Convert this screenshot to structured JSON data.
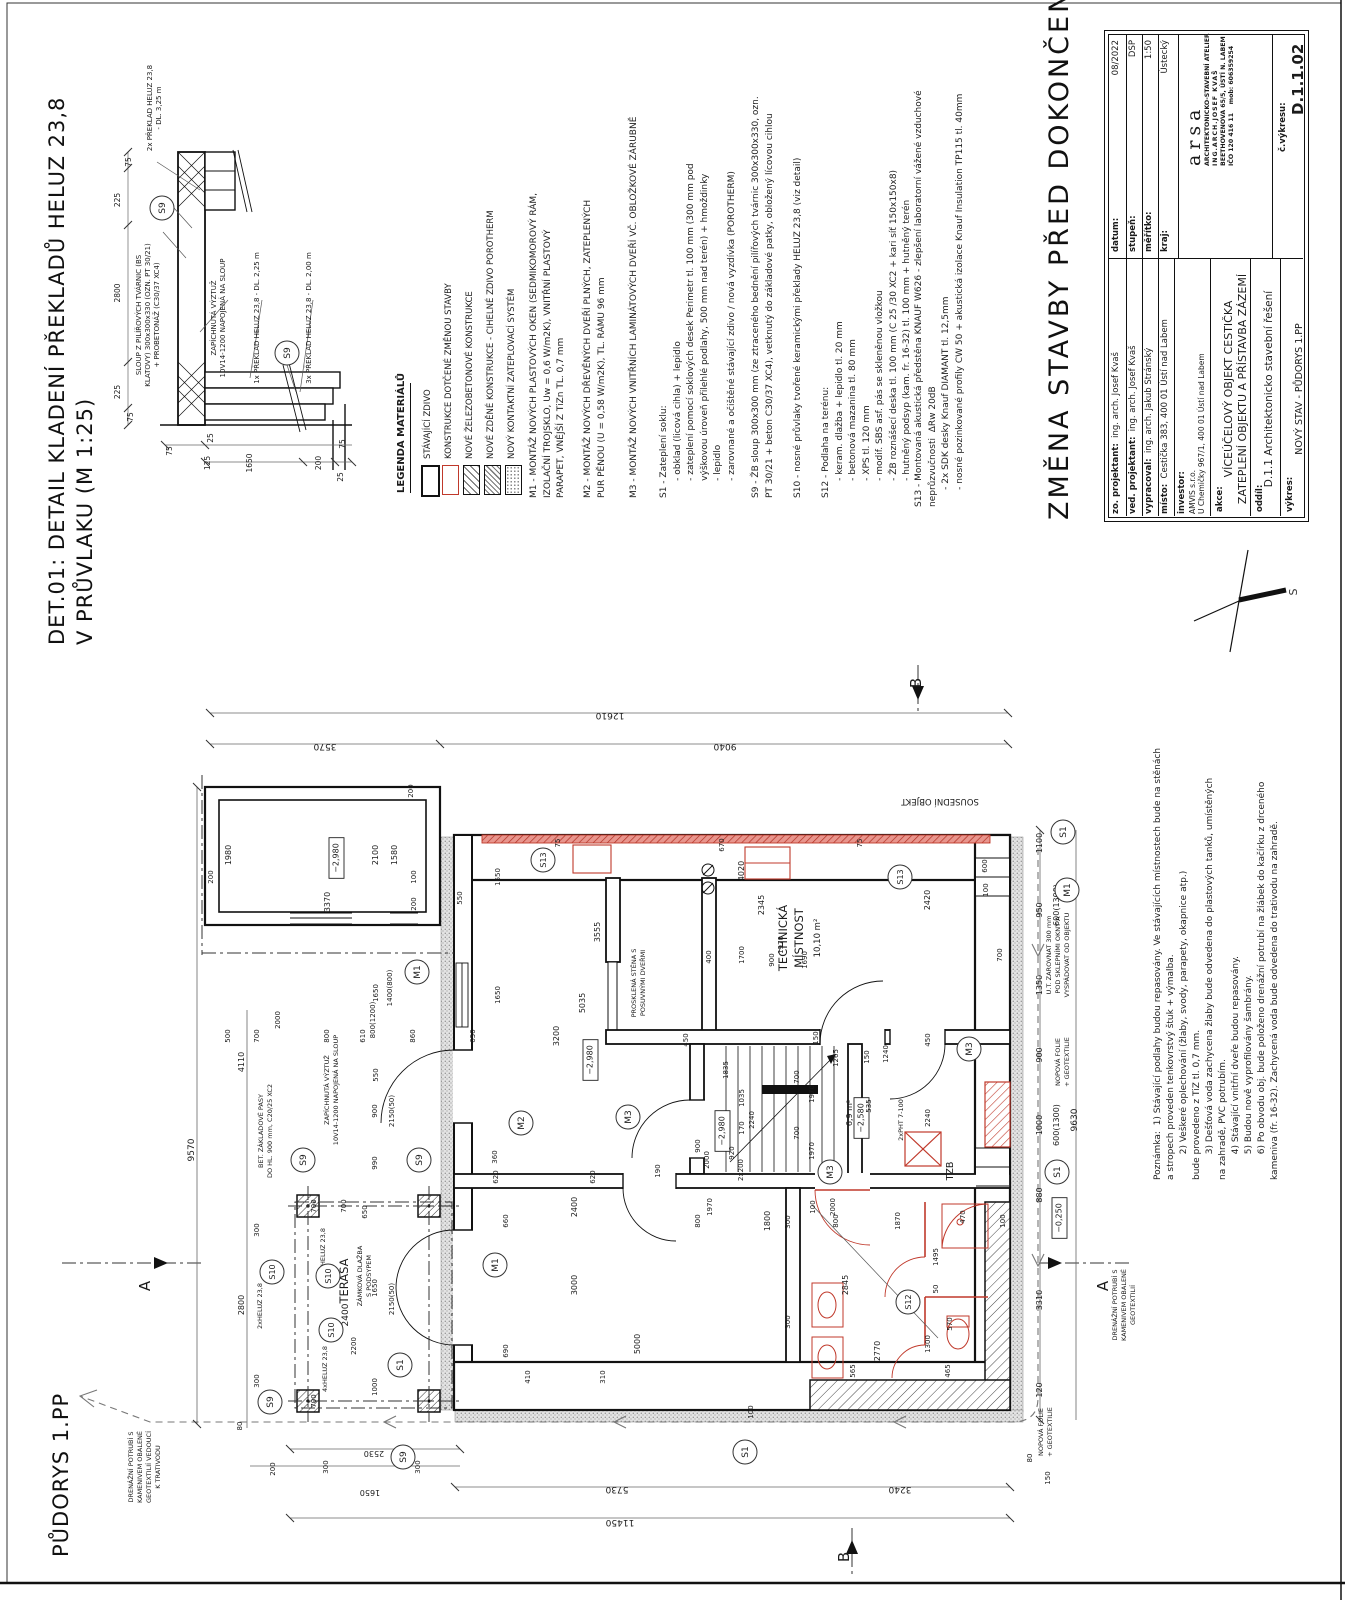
{
  "titles": {
    "det_line1": "DET.01: DETAIL KLADENÍ PŘEKLADŮ HELUZ 23,8",
    "det_line2": "V PRŮVLAKU (M 1:25)",
    "plan_title": "PŮDORYS 1.PP",
    "main_title": "ZMĚNA STAVBY PŘED DOKONČENÍM"
  },
  "compass": {
    "label": "S"
  },
  "legend": {
    "title": "LEGENDA MATERIÁLŮ",
    "items": [
      {
        "label": "STÁVAJÍCÍ ZDIVO",
        "swatch": "existing-masonry"
      },
      {
        "label": "KONSTRUKCE DOTČENÉ ZMĚNOU STAVBY",
        "swatch": "affected-red-outline"
      },
      {
        "label": "NOVÉ ŽELEZOBETONOVÉ KONSTRUKCE",
        "swatch": "new-rc-hatch"
      },
      {
        "label": "NOVÉ ZDĚNÉ KONSTRUKCE - CIHELNÉ ZDIVO POROTHERM",
        "swatch": "new-brick-hatch"
      },
      {
        "label": "NOVÝ KONTAKTNÍ ZATEPLOVACÍ SYSTÉM",
        "swatch": "etics-dots"
      }
    ]
  },
  "notes": {
    "m1": "M1 - MONTÁŽ NOVÝCH PLASTOVÝCH OKEN (SEDMIKOMOROVÝ RÁM,\nIZOLAČNÍ TROJSKLO, Uw = 0,6 W/m2K), VNITŘNÍ PLASTOVÝ\nPARAPET, VNĚJŠÍ Z TiZn TL. 0,7 mm",
    "m2": "M2 - MONTÁŽ NOVÝCH DŘEVĚNÝCH DVEŘÍ PLNÝCH, ZATEPLENÝCH\nPUR PĚNOU (U = 0,58 W/m2K), TL. RÁMU 96 mm",
    "m3": "M3 - MONTÁŽ NOVÝCH VNITŘNÍCH LAMINÁTOVÝCH DVEŘÍ VČ. OBLOŽKOVÉ ZÁRUBNĚ",
    "s1": "S1 - Zateplení soklu:\n      - obklad (licová cihla) + lepidlo\n      - zateplení pomocí soklových desek Perimetr tl. 100 mm (300 mm pod\n      výškovou úroveň přilehlé podlahy, 500 mm nad terén) + hmoždinky\n      - lepidlo\n      - zarovnané a očištěné stávající zdivo / nová vyzdívka (POROTHERM)",
    "s9": "S9 - ŽB sloup 300x300 mm (ze ztraceného bednění pilířových tvárnic 300x300x330, ozn.\nPT 30/21 + beton C30/37 XC4), vetknutý do základové patky, obložený lícovou cihlou",
    "s10": "S10 - nosné průvlaky tvořené keramickými překlady HELUZ 23,8 (viz detail)",
    "s12": "S12 - Podlaha na terénu:\n      - keram. dlažba + lepidlo tl. 20 mm\n      - betonová mazanina tl. 80 mm\n      - XPS tl. 120 mm\n      - modif. SBS asf. pás se skleněnou vložkou\n      - ŽB roznášecí deska tl. 100 mm (C 25 /30 XC2 + kari síť 150x150x8)\n      - hutněný podsyp (kam. fr. 16-32) tl. 100 mm + hutněný terén",
    "s13": "S13 - Montovaná akustická předstěna KNAUF W626 - zlepšení laboratorní vážené vzduchové\nneprůzvučnosti  ΔRw 20dB\n      - 2x SDK desky Knauf DIAMANT tl. 12,5mm\n      - nosné pozinkované profily CW 50 + akustická izolace Knauf Insulation TP115 tl. 40mm",
    "poznamka": "Poznámka:  1) Stávající podlahy budou repasovány. Ve stávajících místnostech bude na stěnách\na stropech proveden tenkovrstvý štuk + výmalba.\n         2) Veškeré oplechování (žlaby, svody, parapety, okapnice atp.)\nbude provedeno z TiZ tl. 0,7 mm.\n         3) Dešťová voda zachycena žlaby bude odvedena do plastových tanků, umístěných\nna zahradě, PVC potrubím.\n         4) Stávající vnitřní dveře budou repasovány.\n         5) Budou nově vyprofilovány šambrány.\n         6) Po obvodu obj. bude položeno drenážní potrubí na žlábek do kačírku z drceného\nkameniva (fr. 16-32). Zachycená voda bude odvedena do trativodu na zahradě."
  },
  "titleblock": {
    "rows": {
      "zo_label": "zo. projektant:",
      "zo_value": "  ing. arch. Josef Kvaš",
      "ved_label": "ved. projektant:",
      "ved_value": "  ing. arch. Josef Kvaš",
      "vyp_label": "vypracoval:",
      "vyp_value": "  ing. arch. Jakub Stránský",
      "misto_label": "místo:",
      "misto_value": "  Cestička 383, 400 01 Ústí nad Labem",
      "inv_label": "investor:",
      "inv_value1": "AMVIS s.r.o.",
      "inv_value2": "U Chemičky 967/1, 400 01 Ústí nad Labem",
      "akce_label": "akce:",
      "akce_value1": "VÍCEÚČELOVÝ OBJEKT CESTIČKA",
      "akce_value2": "ZATEPLENÍ OBJEKTU A PŘÍSTAVBA ZÁZEMÍ",
      "oddil_label": "oddíl:",
      "oddil_value": "D.1.1 Architektonicko stavební řešení",
      "vykres_label": "výkres:",
      "vykres_value": "NOVÝ STAV - PŮDORYS 1.PP",
      "datum_label": "datum:",
      "datum_value": "08/2022",
      "stupen_label": "stupeň:",
      "stupen_value": "DSP",
      "meritko_label": "měřítko:",
      "meritko_value": "1:50",
      "kraj_label": "kraj:",
      "kraj_value": "Ústecký",
      "cis_label": "č.výkresu:",
      "cis_value": "D.1.1.02"
    },
    "arsa": {
      "logo": "arsa",
      "line1": "ARCHITEKTONICKO-STAVEBNÍ ATELIER",
      "line2": "ING.ARCH.JOSEF KVAŠ",
      "line3": "BEETHOVENOVA 65/5, ÚSTÍ N. LABEM",
      "line4": "IČO 120 416 11    mob: 606359254"
    }
  },
  "detail_stamps": [
    [
      "75",
      131,
      162,
      -90,
      7.5
    ],
    [
      "225",
      120,
      200,
      -90,
      7.5
    ],
    [
      "2800",
      120,
      293,
      -90,
      7.5
    ],
    [
      "225",
      120,
      392,
      -90,
      7.5
    ],
    [
      "75",
      133,
      417,
      -90,
      7.5
    ],
    [
      "75",
      172,
      451,
      -90,
      7.5
    ],
    [
      "25",
      213,
      438,
      -90,
      7.5
    ],
    [
      "125",
      210,
      463,
      -90,
      7.5
    ],
    [
      "1650",
      252,
      463,
      -90,
      7.5
    ],
    [
      "200",
      321,
      463,
      -90,
      7.5
    ],
    [
      "25",
      343,
      477,
      -90,
      7.5
    ],
    [
      "75",
      345,
      444,
      -90,
      7.5
    ],
    [
      "2x PŘEKLAD HELUZ 23,8",
      152,
      108,
      -90,
      7
    ],
    [
      "- DL. 3,25 m",
      161,
      108,
      -90,
      7
    ],
    [
      "SLOUP Z PILÍŘOVÝCH TVÁRNIC (BS",
      141,
      315,
      -90,
      7
    ],
    [
      "KLATOVY) 300x300x330 (OZN. PT 30/21)",
      150,
      315,
      -90,
      7
    ],
    [
      "+ PROBETONÁŽ (C30/37 XC4)",
      159,
      315,
      -90,
      7
    ],
    [
      "ZAPÍCHNUTÁ VÝZTUŽ",
      216,
      318,
      -90,
      7
    ],
    [
      "10V14-1200 NAPOJENÁ NA SLOUP",
      225,
      318,
      -90,
      7
    ],
    [
      "1x PŘEKLAD HELUZ 23,8 - DL. 2,25 m",
      259,
      318,
      -90,
      7
    ],
    [
      "3x PŘEKLAD HELUZ 23,8 - DL. 2,00 m",
      311,
      318,
      -90,
      7
    ]
  ],
  "detail_circles": [
    [
      "S9",
      162,
      208
    ],
    [
      "S9",
      287,
      353
    ]
  ],
  "plan_stamps": [
    [
      "12610",
      610,
      713,
      180,
      9
    ],
    [
      "3570",
      325,
      744,
      180,
      9
    ],
    [
      "9040",
      725,
      744,
      180,
      9
    ],
    [
      "200",
      413,
      791,
      -90,
      7
    ],
    [
      "SOUSEDNÍ OBJEKT",
      940,
      799,
      180,
      8.5
    ],
    [
      "9570",
      194,
      1150,
      -90,
      9
    ],
    [
      "4110",
      244,
      1062,
      -90,
      8
    ],
    [
      "2800",
      244,
      1305,
      -90,
      8
    ],
    [
      "500",
      230,
      1036,
      -90,
      7
    ],
    [
      "700",
      259,
      1036,
      -90,
      7
    ],
    [
      "800",
      329,
      1036,
      -90,
      7
    ],
    [
      "610",
      365,
      1036,
      -90,
      7
    ],
    [
      "860",
      415,
      1036,
      -90,
      7
    ],
    [
      "650",
      475,
      1036,
      -90,
      7
    ],
    [
      "2000",
      280,
      1020,
      -90,
      7
    ],
    [
      "800(1200)",
      375,
      1020,
      -90,
      7
    ],
    [
      "3200",
      559,
      1036,
      -90,
      8
    ],
    [
      "550",
      378,
      1075,
      -90,
      7
    ],
    [
      "1650",
      500,
      877,
      -90,
      7
    ],
    [
      "1650",
      500,
      995,
      -90,
      7
    ],
    [
      "3555",
      600,
      932,
      -90,
      8
    ],
    [
      "5035",
      585,
      1003,
      -90,
      8
    ],
    [
      "1400(800)",
      392,
      988,
      -90,
      7
    ],
    [
      "1650",
      378,
      993,
      -90,
      7
    ],
    [
      "300",
      259,
      1230,
      -90,
      7
    ],
    [
      "300",
      259,
      1381,
      -90,
      7
    ],
    [
      "80",
      242,
      1426,
      -90,
      7
    ],
    [
      "1980",
      231,
      855,
      -90,
      8
    ],
    [
      "3370",
      330,
      902,
      -90,
      8
    ],
    [
      "200",
      213,
      877,
      -90,
      7
    ],
    [
      "200",
      416,
      904,
      -90,
      7
    ],
    [
      "100",
      416,
      877,
      -90,
      7
    ],
    [
      "2100",
      378,
      855,
      -90,
      8
    ],
    [
      "1580",
      397,
      855,
      -90,
      8
    ],
    [
      "550",
      462,
      898,
      -90,
      7
    ],
    [
      "−2,980",
      341,
      858,
      -90,
      8,
      "b"
    ],
    [
      "−2,980",
      595,
      1060,
      -90,
      8,
      "b"
    ],
    [
      "−2,980",
      727,
      1131,
      -90,
      8,
      "b"
    ],
    [
      "−2,580",
      866,
      1118,
      -90,
      8,
      "b"
    ],
    [
      "−0,250",
      1064,
      1218,
      -90,
      8,
      "b"
    ],
    [
      "TECHNICKÁ",
      787,
      938,
      -90,
      11.5
    ],
    [
      "MÍSTNOST",
      803,
      938,
      -90,
      11.5
    ],
    [
      "10,10 m²",
      820,
      938,
      -90,
      8.5
    ],
    [
      "4020",
      744,
      871,
      -90,
      8
    ],
    [
      "2345",
      764,
      905,
      -90,
      8
    ],
    [
      "2420",
      930,
      900,
      -90,
      8
    ],
    [
      "670",
      724,
      845,
      -90,
      7
    ],
    [
      "75",
      862,
      843,
      -90,
      7
    ],
    [
      "75",
      560,
      843,
      -90,
      7
    ],
    [
      "1700",
      744,
      955,
      -90,
      7
    ],
    [
      "900",
      774,
      960,
      -90,
      7
    ],
    [
      "1690",
      807,
      960,
      -90,
      7
    ],
    [
      "1970",
      783,
      945,
      -90,
      7
    ],
    [
      "400",
      711,
      957,
      -90,
      7
    ],
    [
      "700",
      1002,
      955,
      -90,
      7
    ],
    [
      "600",
      987,
      866,
      -90,
      7
    ],
    [
      "100",
      988,
      890,
      -90,
      7
    ],
    [
      "PROSKLENÁ STĚNA S",
      636,
      983,
      -90,
      6.5
    ],
    [
      "POSUVNÝMI DVEŘMI",
      645,
      983,
      -90,
      6.5
    ],
    [
      "1835",
      728,
      1070,
      -90,
      7
    ],
    [
      "1035",
      744,
      1098,
      -90,
      7
    ],
    [
      "2240",
      754,
      1120,
      -90,
      7
    ],
    [
      "170",
      744,
      1128,
      -90,
      7
    ],
    [
      "920",
      734,
      1153,
      -90,
      7
    ],
    [
      "2x200",
      743,
      1170,
      -90,
      7
    ],
    [
      "900",
      700,
      1146,
      -90,
      7
    ],
    [
      "2000",
      709,
      1160,
      -90,
      7
    ],
    [
      "6,9 m²",
      852,
      1113,
      -90,
      8
    ],
    [
      "450",
      688,
      1040,
      -90,
      7
    ],
    [
      "150",
      818,
      1038,
      -90,
      7
    ],
    [
      "450",
      930,
      1040,
      -90,
      7
    ],
    [
      "1265",
      838,
      1058,
      -90,
      7
    ],
    [
      "700",
      799,
      1077,
      -90,
      7
    ],
    [
      "1970",
      814,
      1094,
      -90,
      7
    ],
    [
      "150",
      869,
      1057,
      -90,
      7
    ],
    [
      "1240",
      888,
      1054,
      -90,
      7
    ],
    [
      "535",
      871,
      1106,
      -90,
      7
    ],
    [
      "1970",
      814,
      1151,
      -90,
      7
    ],
    [
      "700",
      799,
      1133,
      -90,
      7
    ],
    [
      "2240",
      930,
      1118,
      -90,
      7
    ],
    [
      "2xPHT 7-100",
      903,
      1120,
      -90,
      6.5
    ],
    [
      "155",
      838,
      1176,
      -90,
      7
    ],
    [
      "TZB",
      953,
      1171,
      -90,
      9.5
    ],
    [
      "1100",
      1042,
      843,
      -90,
      8
    ],
    [
      "950",
      1042,
      910,
      -90,
      8
    ],
    [
      "1350",
      1042,
      985,
      -90,
      8
    ],
    [
      "900",
      1042,
      1055,
      -90,
      8
    ],
    [
      "1000",
      1042,
      1125,
      -90,
      8
    ],
    [
      "880",
      1042,
      1195,
      -90,
      8
    ],
    [
      "600(1300)",
      1059,
      905,
      -90,
      8
    ],
    [
      "600(1300)",
      1059,
      1125,
      -90,
      8
    ],
    [
      "9630",
      1077,
      1120,
      -90,
      9
    ],
    [
      "3310",
      1042,
      1300,
      -90,
      8
    ],
    [
      "120",
      1042,
      1390,
      -90,
      8
    ],
    [
      "150",
      1050,
      1478,
      -90,
      7
    ],
    [
      "80",
      1032,
      1458,
      -90,
      7
    ],
    [
      "U.T. ZAROVNAT 300 mm",
      1051,
      955,
      -90,
      6.5
    ],
    [
      "POD SKLEPNÍMI OKNY A",
      1060,
      955,
      -90,
      6.5
    ],
    [
      "VYSPÁDOVAT OD OBJEKTU",
      1069,
      955,
      -90,
      6.5
    ],
    [
      "NOPOVÁ FOLIE",
      1060,
      1062,
      -90,
      6.5
    ],
    [
      "+ GEOTEXTILIE",
      1069,
      1062,
      -90,
      6.5
    ],
    [
      "NOPOVÁ FOLIE",
      1043,
      1432,
      -90,
      6.5
    ],
    [
      "+ GEOTEXTILIE",
      1052,
      1432,
      -90,
      6.5
    ],
    [
      "DRENÁŽNÍ POTRUBÍ S",
      1117,
      1305,
      -90,
      6.5
    ],
    [
      "KAMENIVEM OBALENÉ",
      1126,
      1305,
      -90,
      6.5
    ],
    [
      "GEOTEXTILIÍ",
      1135,
      1305,
      -90,
      6.5
    ],
    [
      "DRENÁŽNÍ POTRUBÍ S",
      133,
      1467,
      -90,
      6.5
    ],
    [
      "KAMENIVEM OBALENÉ",
      142,
      1467,
      -90,
      6.5
    ],
    [
      "GEOTEXTILIÍ VEDOUCÍ",
      151,
      1467,
      -90,
      6.5
    ],
    [
      "K TRATIVODU",
      160,
      1467,
      -90,
      6.5
    ],
    [
      "TERASA",
      348,
      1281,
      -90,
      11.5
    ],
    [
      "2400",
      348,
      1315,
      -90,
      9
    ],
    [
      "ZÁMKOVÁ DLAŽBA",
      362,
      1276,
      -90,
      6.5
    ],
    [
      "S PODSYPEM",
      371,
      1276,
      -90,
      6.5
    ],
    [
      "4xHELUZ 23,8",
      325,
      1251,
      -90,
      6.5
    ],
    [
      "4xHELUZ 23,8",
      327,
      1369,
      -90,
      6.5
    ],
    [
      "2xHELUZ 23,8",
      262,
      1306,
      -90,
      6.5
    ],
    [
      "BET. ZÁKLADOVÉ PASY",
      263,
      1131,
      -90,
      6.5
    ],
    [
      "DO HL. 900 mm, C20/25 XC2",
      272,
      1131,
      -90,
      6.5
    ],
    [
      "ZAPÍCHNUTÁ VÝZTUŽ",
      329,
      1090,
      -90,
      6.5
    ],
    [
      "10V14-1200 NAPOJENÁ NA SLOUP",
      338,
      1090,
      -90,
      6.5
    ],
    [
      "990",
      377,
      1163,
      -90,
      7
    ],
    [
      "700",
      346,
      1206,
      -90,
      7
    ],
    [
      "650",
      367,
      1212,
      -90,
      7
    ],
    [
      "1650",
      377,
      1288,
      -90,
      7
    ],
    [
      "2200",
      356,
      1346,
      -90,
      7
    ],
    [
      "1000",
      377,
      1387,
      -90,
      7
    ],
    [
      "700",
      316,
      1206,
      -90,
      7
    ],
    [
      "700",
      316,
      1401,
      -90,
      7
    ],
    [
      "2150(50)",
      394,
      1111,
      -90,
      7
    ],
    [
      "2150(50)",
      394,
      1299,
      -90,
      7
    ],
    [
      "900",
      377,
      1111,
      -90,
      7
    ],
    [
      "2530",
      374,
      1451,
      180,
      8
    ],
    [
      "1650",
      370,
      1490,
      180,
      8
    ],
    [
      "200",
      275,
      1469,
      -90,
      7
    ],
    [
      "300",
      328,
      1467,
      -90,
      7
    ],
    [
      "300",
      420,
      1467,
      -90,
      7
    ],
    [
      "5730",
      617,
      1487,
      180,
      9
    ],
    [
      "3240",
      900,
      1487,
      180,
      9
    ],
    [
      "11450",
      620,
      1520,
      180,
      9
    ],
    [
      "100",
      753,
      1412,
      -90,
      7
    ],
    [
      "2400",
      577,
      1207,
      -90,
      8
    ],
    [
      "3000",
      577,
      1285,
      -90,
      8
    ],
    [
      "5000",
      640,
      1344,
      -90,
      8
    ],
    [
      "310",
      605,
      1377,
      -90,
      7
    ],
    [
      "410",
      530,
      1377,
      -90,
      7
    ],
    [
      "690",
      508,
      1351,
      -90,
      7
    ],
    [
      "660",
      508,
      1221,
      -90,
      7
    ],
    [
      "360",
      497,
      1157,
      -90,
      7
    ],
    [
      "620",
      498,
      1177,
      -90,
      7
    ],
    [
      "620",
      595,
      1177,
      -90,
      7
    ],
    [
      "190",
      660,
      1171,
      -90,
      7
    ],
    [
      "1970",
      712,
      1207,
      -90,
      7
    ],
    [
      "800",
      700,
      1221,
      -90,
      7
    ],
    [
      "1800",
      770,
      1221,
      -90,
      8
    ],
    [
      "300",
      790,
      1222,
      -90,
      7
    ],
    [
      "100",
      815,
      1207,
      -90,
      7
    ],
    [
      "2000",
      835,
      1207,
      -90,
      7
    ],
    [
      "800",
      838,
      1221,
      -90,
      7
    ],
    [
      "1870",
      900,
      1221,
      -90,
      7
    ],
    [
      "470",
      965,
      1217,
      -90,
      7
    ],
    [
      "100",
      1005,
      1221,
      -90,
      7
    ],
    [
      "2845",
      848,
      1285,
      -90,
      8
    ],
    [
      "300",
      790,
      1322,
      -90,
      7
    ],
    [
      "1495",
      938,
      1257,
      -90,
      7
    ],
    [
      "50",
      938,
      1289,
      -90,
      7
    ],
    [
      "570",
      952,
      1324,
      -90,
      7
    ],
    [
      "1300",
      930,
      1344,
      -90,
      7
    ],
    [
      "465",
      950,
      1371,
      -90,
      7
    ],
    [
      "565",
      855,
      1371,
      -90,
      7
    ],
    [
      "2770",
      880,
      1351,
      -90,
      8
    ],
    [
      "A",
      150,
      1286,
      -90,
      15
    ],
    [
      "A",
      1108,
      1286,
      -90,
      15
    ],
    [
      "B",
      921,
      683,
      -90,
      15
    ],
    [
      "B",
      849,
      1557,
      -90,
      15
    ]
  ],
  "plan_circles": [
    [
      "S13",
      543,
      860
    ],
    [
      "S13",
      900,
      877
    ],
    [
      "S1",
      1063,
      832
    ],
    [
      "S1",
      1057,
      1172
    ],
    [
      "S1",
      400,
      1365
    ],
    [
      "S1",
      745,
      1452
    ],
    [
      "M1",
      417,
      972
    ],
    [
      "M1",
      495,
      1265
    ],
    [
      "M1",
      1067,
      890
    ],
    [
      "M2",
      521,
      1123
    ],
    [
      "M3",
      628,
      1117
    ],
    [
      "M3",
      969,
      1049
    ],
    [
      "M3",
      830,
      1172
    ],
    [
      "S12",
      908,
      1302
    ],
    [
      "S9",
      303,
      1160
    ],
    [
      "S9",
      419,
      1160
    ],
    [
      "S9",
      270,
      1402
    ],
    [
      "S9",
      403,
      1457
    ],
    [
      "S10",
      272,
      1272
    ],
    [
      "S10",
      328,
      1276
    ],
    [
      "S10",
      331,
      1330
    ]
  ],
  "colors": {
    "accent_red": "#c0392b",
    "line": "#111111",
    "dim": "#555555"
  }
}
